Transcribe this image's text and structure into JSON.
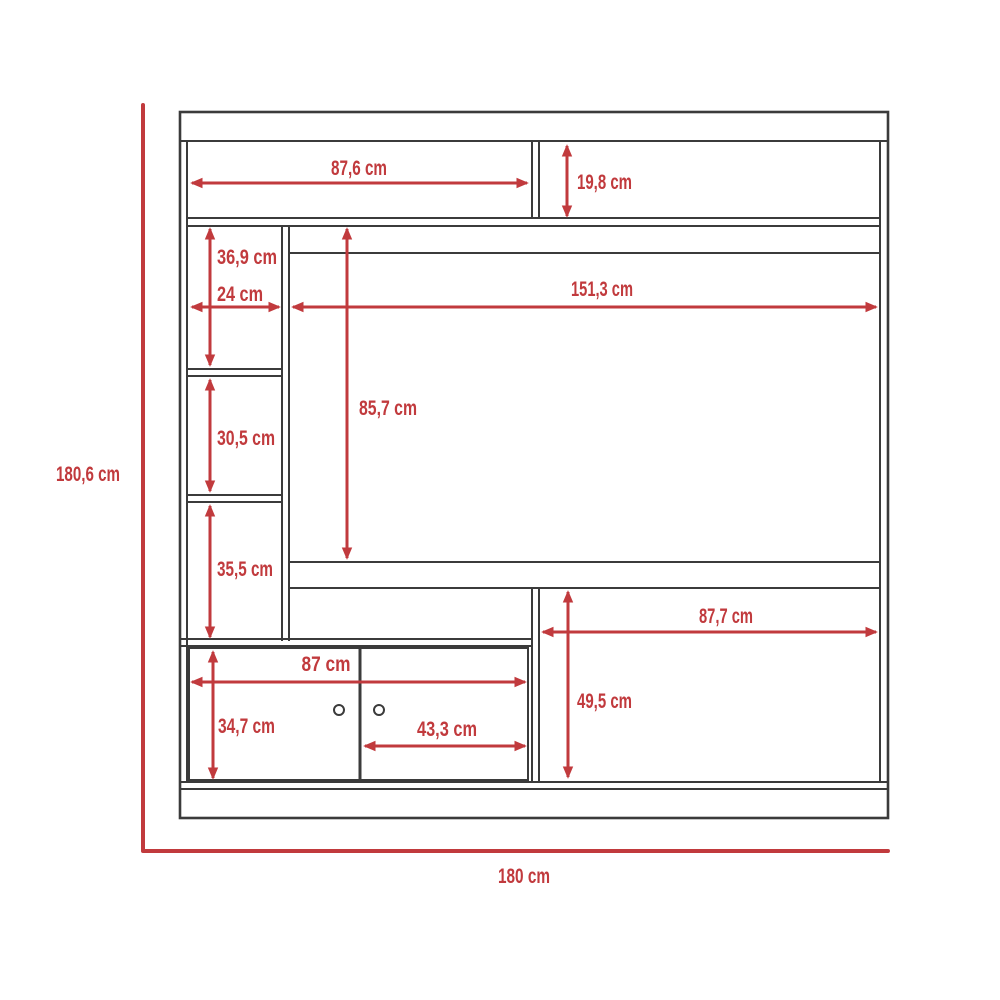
{
  "figure": {
    "type": "furniture-dimension-diagram",
    "subject": "TV wall unit front elevation with dimensions",
    "units": "cm",
    "colors": {
      "dimension": "#c13a3d",
      "structure": "#3b3b3b",
      "background": "#ffffff"
    }
  },
  "dimensions": {
    "overall_height": {
      "label": "180,6 cm",
      "value_cm": 180.6
    },
    "overall_width": {
      "label": "180 cm",
      "value_cm": 180
    },
    "top_shelf_width": {
      "label": "87,6 cm",
      "value_cm": 87.6
    },
    "top_shelf_height": {
      "label": "19,8 cm",
      "value_cm": 19.8
    },
    "cubby_top_height": {
      "label": "36,9 cm",
      "value_cm": 36.9
    },
    "cubby_width": {
      "label": "24 cm",
      "value_cm": 24
    },
    "tv_opening_width": {
      "label": "151,3 cm",
      "value_cm": 151.3
    },
    "tv_opening_height": {
      "label": "85,7 cm",
      "value_cm": 85.7
    },
    "cubby_middle_height": {
      "label": "30,5 cm",
      "value_cm": 30.5
    },
    "cubby_bottom_height": {
      "label": "35,5 cm",
      "value_cm": 35.5
    },
    "cabinet_width": {
      "label": "87 cm",
      "value_cm": 87
    },
    "cabinet_height": {
      "label": "34,7 cm",
      "value_cm": 34.7
    },
    "cabinet_door_width": {
      "label": "43,3 cm",
      "value_cm": 43.3
    },
    "right_opening_width": {
      "label": "87,7 cm",
      "value_cm": 87.7
    },
    "right_opening_height": {
      "label": "49,5 cm",
      "value_cm": 49.5
    }
  }
}
